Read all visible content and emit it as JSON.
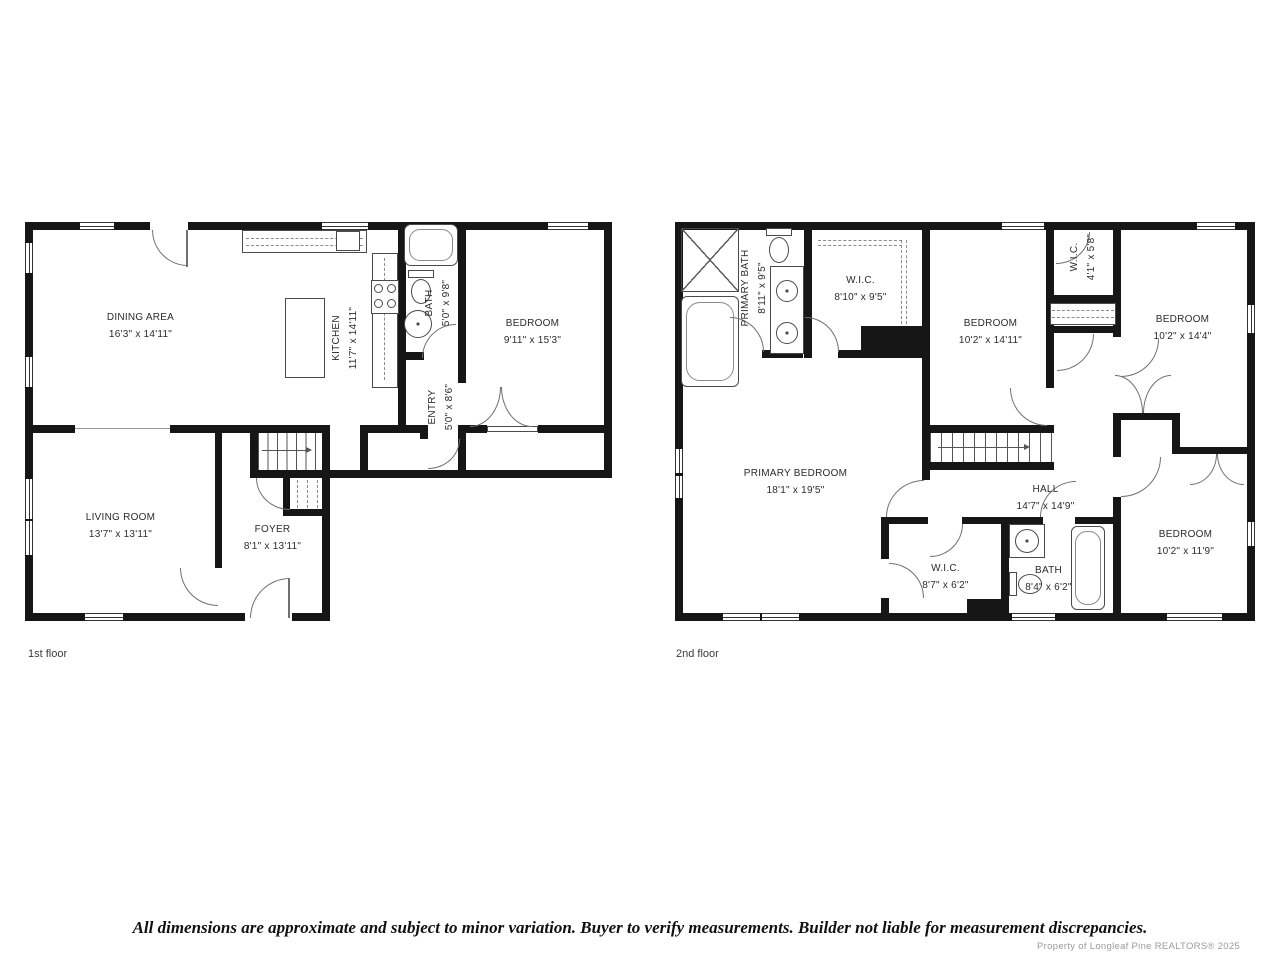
{
  "colors": {
    "wall": "#161616",
    "fixture_line": "#4a4a4a",
    "door_arc": "#707070",
    "label_text": "#2b2b2b",
    "watermark_text": "#9a9a9a"
  },
  "floors": [
    {
      "label": "1st floor",
      "rooms": {
        "dining": {
          "name": "DINING AREA",
          "dims": "16'3\" x 14'11\""
        },
        "kitchen": {
          "name": "KITCHEN",
          "dims": "11'7\" x 14'11\""
        },
        "bath": {
          "name": "BATH",
          "dims": "5'0\" x 9'8\""
        },
        "bedroom": {
          "name": "BEDROOM",
          "dims": "9'11\" x 15'3\""
        },
        "entry": {
          "name": "ENTRY",
          "dims": "5'0\" x 8'6\""
        },
        "living": {
          "name": "LIVING ROOM",
          "dims": "13'7\" x 13'11\""
        },
        "foyer": {
          "name": "FOYER",
          "dims": "8'1\" x 13'11\""
        }
      }
    },
    {
      "label": "2nd floor",
      "rooms": {
        "primary_bath": {
          "name": "PRIMARY BATH",
          "dims": "8'11\" x 9'5\""
        },
        "wic_main": {
          "name": "W.I.C.",
          "dims": "8'10\" x 9'5\""
        },
        "bedroom_mid": {
          "name": "BEDROOM",
          "dims": "10'2\" x 14'11\""
        },
        "wic_small": {
          "name": "W.I.C.",
          "dims": "4'1\" x 5'8\""
        },
        "bedroom_tr": {
          "name": "BEDROOM",
          "dims": "10'2\" x 14'4\""
        },
        "primary_bedroom": {
          "name": "PRIMARY BEDROOM",
          "dims": "18'1\" x 19'5\""
        },
        "hall": {
          "name": "HALL",
          "dims": "14'7\" x 14'9\""
        },
        "wic_lower": {
          "name": "W.I.C.",
          "dims": "8'7\" x 6'2\""
        },
        "bath": {
          "name": "BATH",
          "dims": "8'4\" x 6'2\""
        },
        "bedroom_br": {
          "name": "BEDROOM",
          "dims": "10'2\" x 11'9\""
        }
      }
    }
  ],
  "footer": {
    "disclaimer": "All dimensions are approximate and subject to minor variation. Buyer to verify measurements. Builder not liable for measurement discrepancies.",
    "watermark": "Property of Longleaf Pine REALTORS® 2025"
  }
}
